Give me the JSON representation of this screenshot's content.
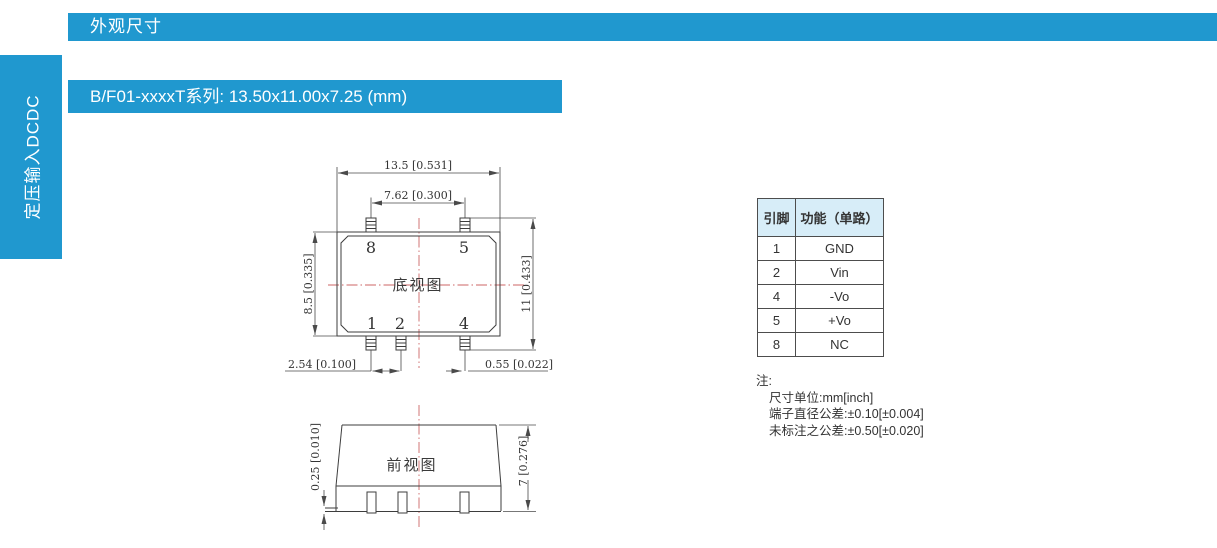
{
  "header": {
    "title": "外观尺寸"
  },
  "sidebar": {
    "label": "定压输入DCDC"
  },
  "section_title": {
    "text": "B/F01-xxxxT系列: 13.50x11.00x7.25 (mm)"
  },
  "drawing": {
    "bottom_view": {
      "label": "底视图",
      "dim_body_width": "13.5 [0.531]",
      "dim_pin_span": "7.62 [0.300]",
      "dim_body_height": "8.5 [0.335]",
      "dim_overall_height": "11 [0.433]",
      "dim_pin_pitch": "2.54 [0.100]",
      "dim_pin_diameter": "0.55 [0.022]",
      "pin_numbers": {
        "p8": "8",
        "p5": "5",
        "p1": "1",
        "p2": "2",
        "p4": "4"
      }
    },
    "front_view": {
      "label": "前视图",
      "dim_standoff": "0.25 [0.010]",
      "dim_height": "7 [0.276]"
    }
  },
  "pin_table": {
    "headers": [
      "引脚",
      "功能（单路）"
    ],
    "rows": [
      {
        "pin": "1",
        "function": "GND"
      },
      {
        "pin": "2",
        "function": "Vin"
      },
      {
        "pin": "4",
        "function": "-Vo"
      },
      {
        "pin": "5",
        "function": "+Vo"
      },
      {
        "pin": "8",
        "function": "NC"
      }
    ]
  },
  "notes": {
    "title": "注:",
    "lines": [
      "尺寸单位:mm[inch]",
      "端子直径公差:±0.10[±0.004]",
      "未标注之公差:±0.50[±0.020]"
    ]
  },
  "colors": {
    "accent_blue": "#2098cf",
    "table_header_bg": "#d7edf8",
    "drawing_line": "#3d3d3d",
    "centerline_red": "#cc6666",
    "text_dark": "#333333"
  }
}
